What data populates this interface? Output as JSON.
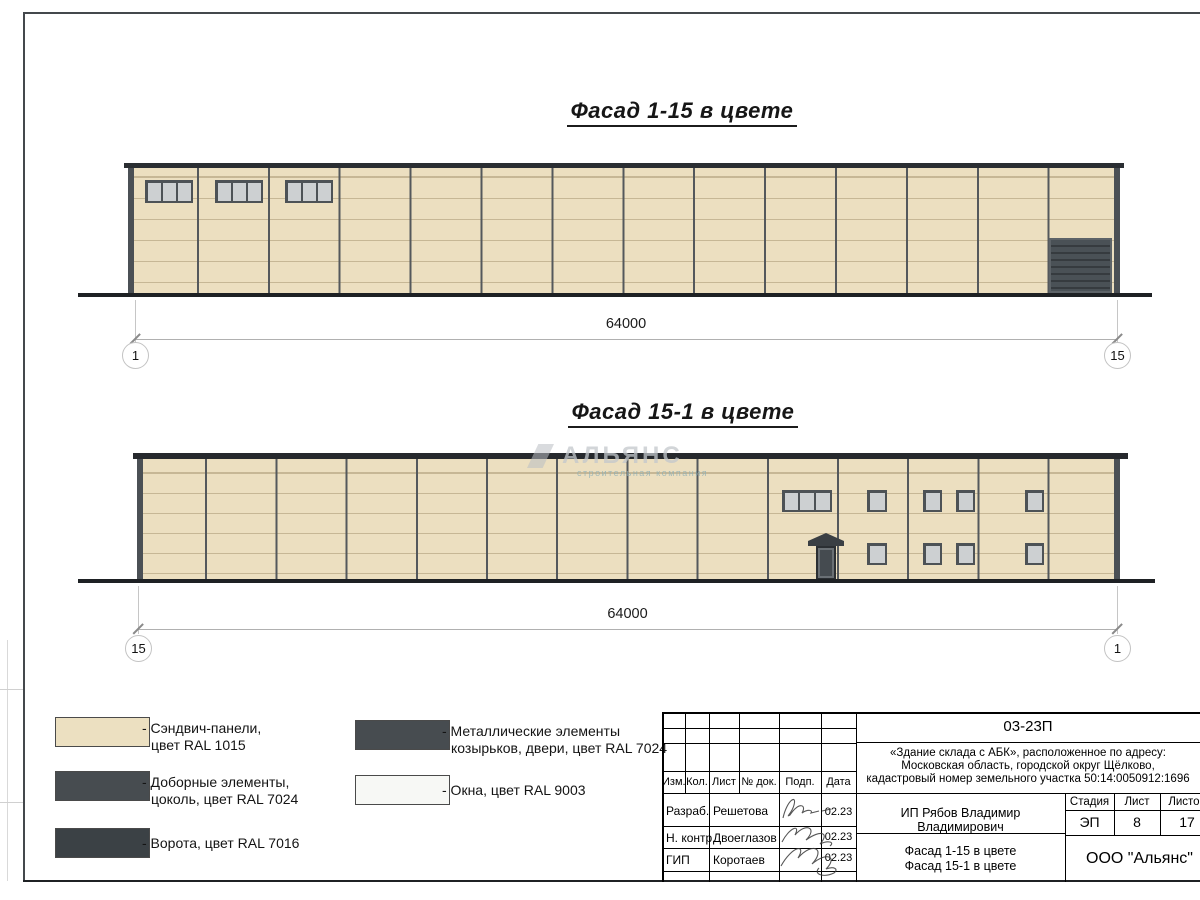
{
  "facade1": {
    "title": "Фасад 1-15 в цвете",
    "dimension": "64000",
    "axis_left": "1",
    "axis_right": "15"
  },
  "facade2": {
    "title": "Фасад 15-1 в цвете",
    "dimension": "64000",
    "axis_left": "15",
    "axis_right": "1"
  },
  "watermark": {
    "name": "АЛЬЯНС",
    "tagline": "строительная компания"
  },
  "legend": {
    "items": [
      {
        "swatch": "#ece0c1",
        "line1": "- Сэндвич-панели,",
        "line2": "цвет RAL 1015"
      },
      {
        "swatch": "#474c50",
        "line1": "- Доборные элементы,",
        "line2": "цоколь, цвет RAL 7024"
      },
      {
        "swatch": "#3b4145",
        "line1": "- Ворота, цвет RAL 7016",
        "line2": ""
      },
      {
        "swatch": "#474c50",
        "line1": "- Металлические элементы",
        "line2": "козырьков, двери, цвет RAL 7024"
      },
      {
        "swatch": "#f7f8f5",
        "line1": "- Окна, цвет RAL 9003",
        "line2": ""
      }
    ]
  },
  "stamp": {
    "code": "03-23П",
    "address_lines": [
      "«Здание склада с АБК», расположенное по адресу:",
      "Московская область, городской округ Щёлково,",
      "кадастровый номер земельного участка 50:14:0050912:1696"
    ],
    "columns": [
      "Изм.",
      "Кол.",
      "Лист",
      "№ док.",
      "Подп.",
      "Дата"
    ],
    "rows": [
      {
        "role": "Разраб.",
        "name": "Решетова",
        "date": "02.23"
      },
      {
        "role": "Н. контр.",
        "name": "Двоеглазов",
        "date": "02.23"
      },
      {
        "role": "ГИП",
        "name": "Коротаев",
        "date": "02.23"
      }
    ],
    "client": "ИП Рябов Владимир Владимирович",
    "object_lines": [
      "Фасад 1-15 в цвете",
      "Фасад 15-1 в цвете"
    ],
    "stage_label": "Стадия",
    "stage_value": "ЭП",
    "sheet_label": "Лист",
    "sheet_value": "8",
    "sheets_label": "Листов",
    "sheets_value": "17",
    "company": "ООО \"Альянс\""
  },
  "colors": {
    "panel_ral1015": "#ecdfc0",
    "trim_ral7024": "#4b5055",
    "gate_ral7016": "#3b4145",
    "window_ral9003": "#cdd0d2",
    "ground": "#1e2124"
  }
}
